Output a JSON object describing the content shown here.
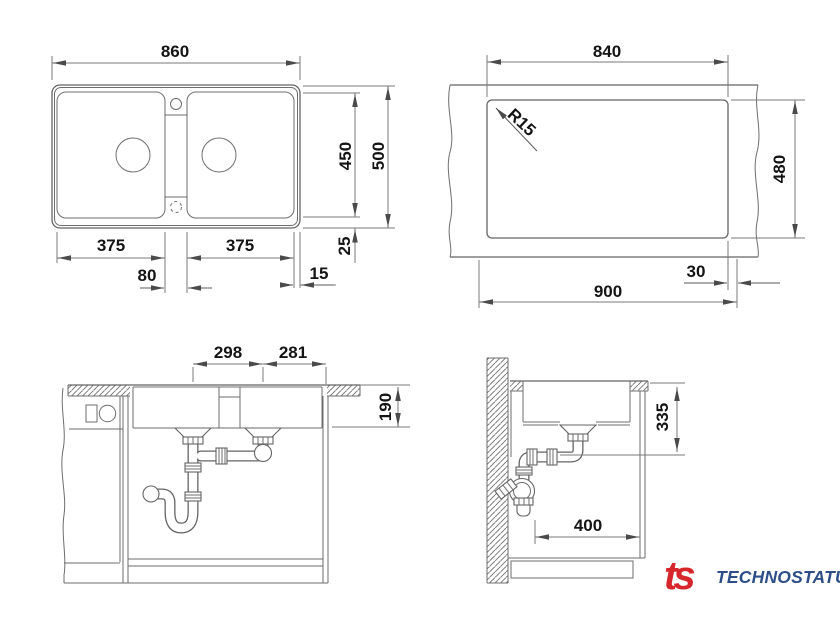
{
  "drawing": {
    "plan": {
      "overall_width": "860",
      "inner_depth": "450",
      "overall_depth": "500",
      "bowl_left_width": "375",
      "bowl_right_width": "375",
      "divider_width": "80",
      "edge_gap": "15",
      "rim_gap": "25"
    },
    "cutout": {
      "width": "840",
      "corner_radius": "R15",
      "depth": "480",
      "cabinet_width": "900",
      "edge_offset": "30"
    },
    "front": {
      "drain_spacing": "298",
      "drain_to_edge": "281",
      "bowl_depth": "190"
    },
    "side": {
      "drain_height": "335",
      "drain_wall_offset": "400"
    }
  },
  "logo": {
    "mark": "ts",
    "name": "TECHNOSTATUS"
  },
  "colors": {
    "object_line": "#646464",
    "dimension_line": "#7a7a7a",
    "text": "#141414",
    "logo_mark": "#d6252b",
    "logo_name": "#2d4e87",
    "background": "#ffffff"
  }
}
